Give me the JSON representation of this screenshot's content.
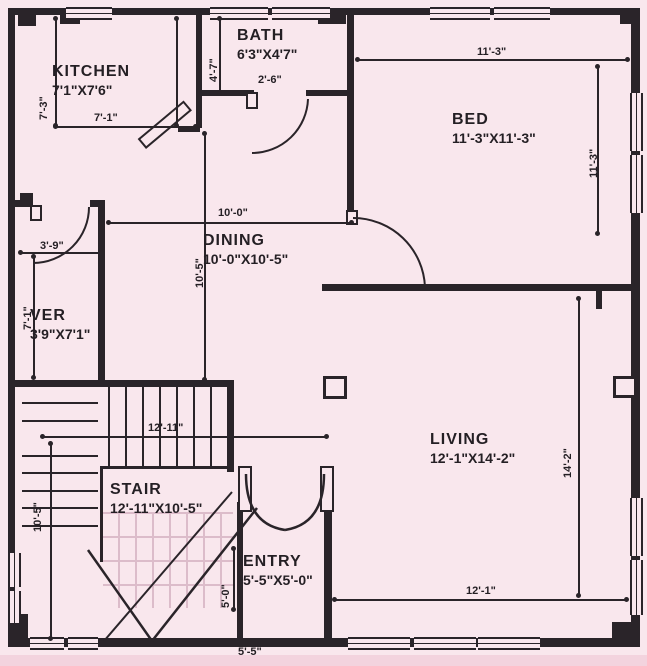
{
  "title": "House Floor Plan",
  "colors": {
    "background": "#f9e7ed",
    "line": "#2a2429",
    "faint_tread": "#dcbcca",
    "bottom_strip": "#f3d3de"
  },
  "rooms": [
    {
      "name": "KITCHEN",
      "size": "7'1\"X7'6\"",
      "x": 52,
      "y": 62
    },
    {
      "name": "BATH",
      "size": "6'3\"X4'7\"",
      "x": 237,
      "y": 26
    },
    {
      "name": "BED",
      "size": "11'-3\"X11'-3\"",
      "x": 452,
      "y": 110
    },
    {
      "name": "DINING",
      "size": "10'-0\"X10'-5\"",
      "x": 203,
      "y": 231
    },
    {
      "name": "VER",
      "size": "3'9\"X7'1\"",
      "x": 30,
      "y": 306
    },
    {
      "name": "STAIR",
      "size": "12'-11\"X10'-5\"",
      "x": 110,
      "y": 480
    },
    {
      "name": "ENTRY",
      "size": "5'-5\"X5'-0\"",
      "x": 243,
      "y": 552
    },
    {
      "name": "LIVING",
      "size": "12'-1\"X14'-2\"",
      "x": 430,
      "y": 430
    }
  ],
  "dims": [
    {
      "text": "11'-3\"",
      "x": 477,
      "y": 46,
      "rot": false
    },
    {
      "text": "11'-3\"",
      "x": 588,
      "y": 178,
      "rot": true
    },
    {
      "text": "4'-7\"",
      "x": 208,
      "y": 82,
      "rot": true
    },
    {
      "text": "7'-1\"",
      "x": 94,
      "y": 112,
      "rot": false
    },
    {
      "text": "7'-3\"",
      "x": 38,
      "y": 120,
      "rot": true
    },
    {
      "text": "2'-6\"",
      "x": 258,
      "y": 74,
      "rot": false
    },
    {
      "text": "10'-0\"",
      "x": 218,
      "y": 207,
      "rot": false
    },
    {
      "text": "10'-5\"",
      "x": 194,
      "y": 288,
      "rot": true
    },
    {
      "text": "3'-9\"",
      "x": 40,
      "y": 240,
      "rot": false
    },
    {
      "text": "7'-1\"",
      "x": 22,
      "y": 330,
      "rot": true
    },
    {
      "text": "12'-11\"",
      "x": 148,
      "y": 422,
      "rot": false
    },
    {
      "text": "10'-5\"",
      "x": 32,
      "y": 532,
      "rot": true
    },
    {
      "text": "5'-0\"",
      "x": 220,
      "y": 608,
      "rot": true
    },
    {
      "text": "12'-1\"",
      "x": 466,
      "y": 585,
      "rot": false
    },
    {
      "text": "14'-2\"",
      "x": 562,
      "y": 478,
      "rot": true
    },
    {
      "text": "5'-5\"",
      "x": 238,
      "y": 646,
      "rot": false
    }
  ]
}
